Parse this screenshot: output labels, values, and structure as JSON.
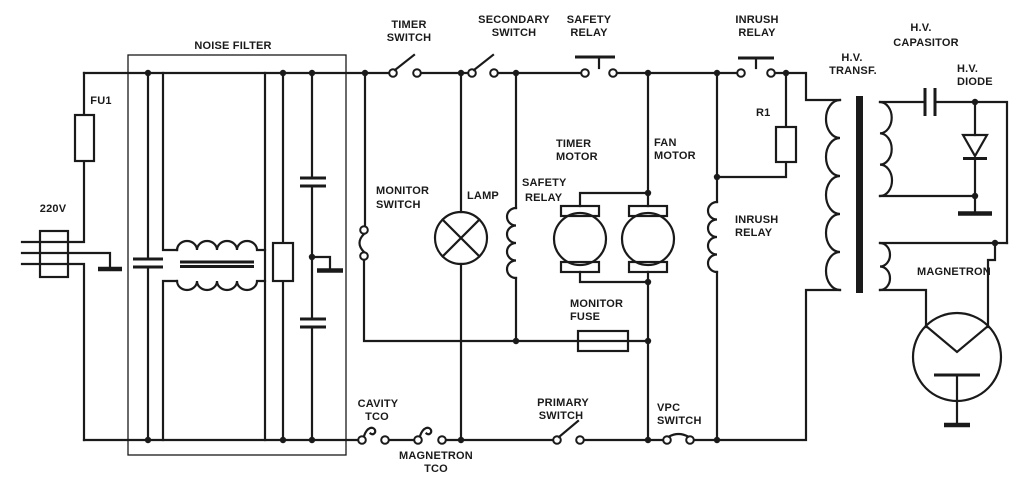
{
  "diagram": {
    "title": "Microwave oven circuit schematic",
    "colors": {
      "ink": "#1a1a1a",
      "background": "#ffffff"
    },
    "labels": {
      "voltage": "220V",
      "fuse": "FU1",
      "noise_filter": "NOISE FILTER",
      "timer_switch": {
        "line1": "TIMER",
        "line2": "SWITCH"
      },
      "secondary_switch": {
        "line1": "SECONDARY",
        "line2": "SWITCH"
      },
      "safety_relay_contact": {
        "line1": "SAFETY",
        "line2": "RELAY"
      },
      "inrush_relay_contact": {
        "line1": "INRUSH",
        "line2": "RELAY"
      },
      "hv_transformer": {
        "line1": "H.V.",
        "line2": "TRANSF."
      },
      "hv_capacitor": {
        "line1": "H.V.",
        "line2": "CAPASITOR"
      },
      "hv_diode": {
        "line1": "H.V.",
        "line2": "DIODE"
      },
      "monitor_switch": {
        "line1": "MONITOR",
        "line2": "SWITCH"
      },
      "lamp": "LAMP",
      "safety_relay_coil": {
        "line1": "SAFETY",
        "line2": "RELAY"
      },
      "timer_motor": {
        "line1": "TIMER",
        "line2": "MOTOR"
      },
      "fan_motor": {
        "line1": "FAN",
        "line2": "MOTOR"
      },
      "monitor_fuse": {
        "line1": "MONITOR",
        "line2": "FUSE"
      },
      "inrush_relay_coil": {
        "line1": "INRUSH",
        "line2": "RELAY"
      },
      "r1": "R1",
      "magnetron": "MAGNETRON",
      "cavity_tco": {
        "line1": "CAVITY",
        "line2": "TCO"
      },
      "magnetron_tco": {
        "line1": "MAGNETRON",
        "line2": "TCO"
      },
      "primary_switch": {
        "line1": "PRIMARY",
        "line2": "SWITCH"
      },
      "vpc_switch": {
        "line1": "VPC",
        "line2": "SWITCH"
      }
    }
  }
}
